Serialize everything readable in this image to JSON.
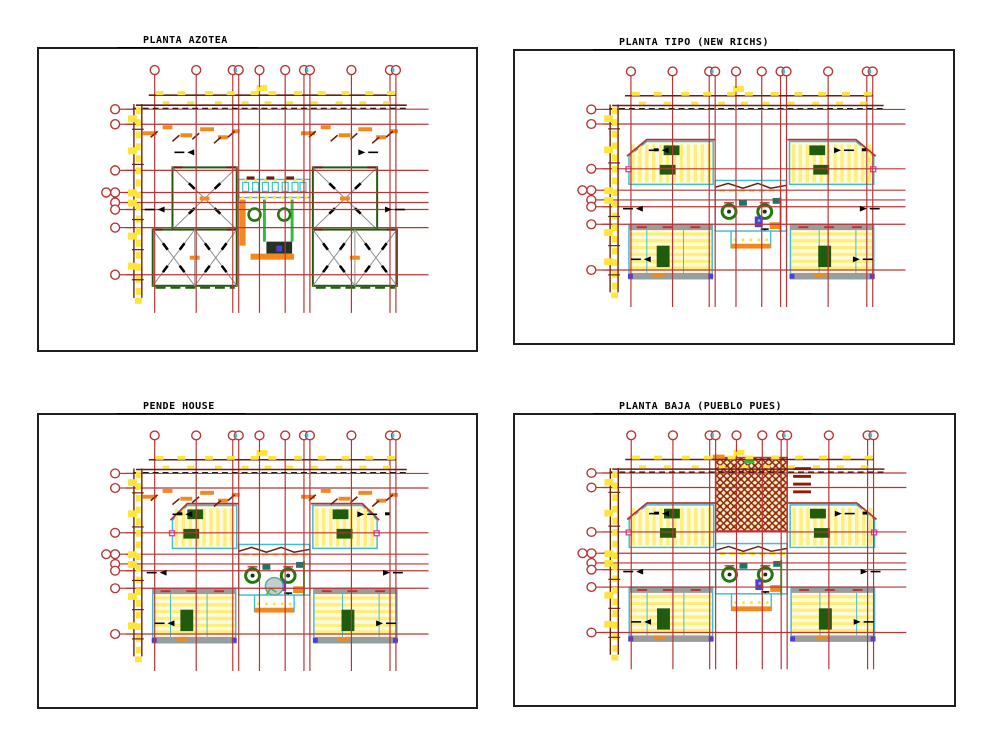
{
  "sheet": {
    "description": "CAD architectural drawing sheet with four floor plan views",
    "background": "#ffffff"
  },
  "panels": [
    {
      "id": "planta-azotea",
      "title": "PLANTA AZOTEA",
      "variant": "azotea"
    },
    {
      "id": "planta-tipo",
      "title": "PLANTA TIPO (NEW RICHS)",
      "variant": "tipo"
    },
    {
      "id": "pende-house",
      "title": "PENDE HOUSE",
      "variant": "pende"
    },
    {
      "id": "planta-baja",
      "title": "PLANTA BAJA (PUEBLO PUES)",
      "variant": "baja"
    }
  ],
  "colors": {
    "grid_red": "#BB3434",
    "dark_red": "#6E1E0C",
    "yellow": "#FFE43A",
    "pale_yellow": "#FFFBE0",
    "stripe_yellow": "#FFEE77",
    "cyan": "#3FBFCF",
    "dark_green": "#1F5C0E",
    "bright_green": "#2FBF3F",
    "orange": "#F2891E",
    "gray": "#9C9C9C",
    "diag_gray": "#8F8F8F",
    "magenta": "#E03FB8",
    "blue": "#4A3FD9",
    "black": "#000000",
    "frame": "#1F1F1F",
    "hatch_gold": "#D9A520",
    "hatch_red": "#8B1E08"
  },
  "symbols": {
    "grid_bubble_icon": "column-grid-bubble (red circle with stem)",
    "direction_arrow_icon": "black directional arrow",
    "roof_slope_icon": "gray X diagonals with black slope arrows",
    "paver_hatch_icon": "red lattice with gold dots (patio paving)"
  }
}
